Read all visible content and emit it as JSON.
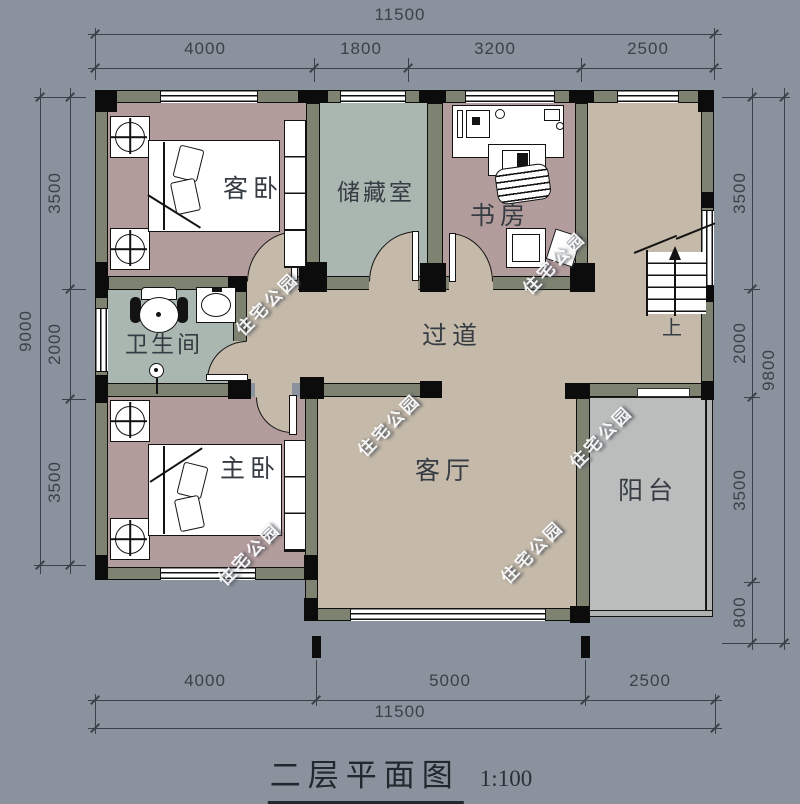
{
  "title": {
    "main": "二层平面图",
    "scale": "1:100"
  },
  "watermark": {
    "text": "住宅公园"
  },
  "stairs": {
    "up": "上"
  },
  "rooms": {
    "guest_bedroom": {
      "label": "客卧"
    },
    "storage": {
      "label": "储藏室"
    },
    "study": {
      "label": "书房"
    },
    "bathroom": {
      "label": "卫生间"
    },
    "hallway": {
      "label": "过道"
    },
    "master_bedroom": {
      "label": "主卧"
    },
    "living_room": {
      "label": "客厅"
    },
    "balcony": {
      "label": "阳台"
    }
  },
  "dimensions": {
    "top": {
      "total": "11500",
      "segments": [
        "4000",
        "1800",
        "3200",
        "2500"
      ]
    },
    "bottom": {
      "total": "11500",
      "segments": [
        "4000",
        "5000",
        "2500"
      ]
    },
    "left": {
      "total": "9000",
      "segments": [
        "3500",
        "2000",
        "3500"
      ]
    },
    "right": {
      "total": "9800",
      "segments": [
        "3500",
        "2000",
        "3500",
        "800"
      ]
    }
  },
  "colors": {
    "background": "#8a939d",
    "bedroom_floor": "#b39c9c",
    "utility_floor": "#aab7b1",
    "hall_floor": "#c5baa9",
    "balcony_floor": "#babdbb",
    "wall_fill": "#7d8271",
    "line": "#131313",
    "dimension_text": "#3a4149"
  }
}
